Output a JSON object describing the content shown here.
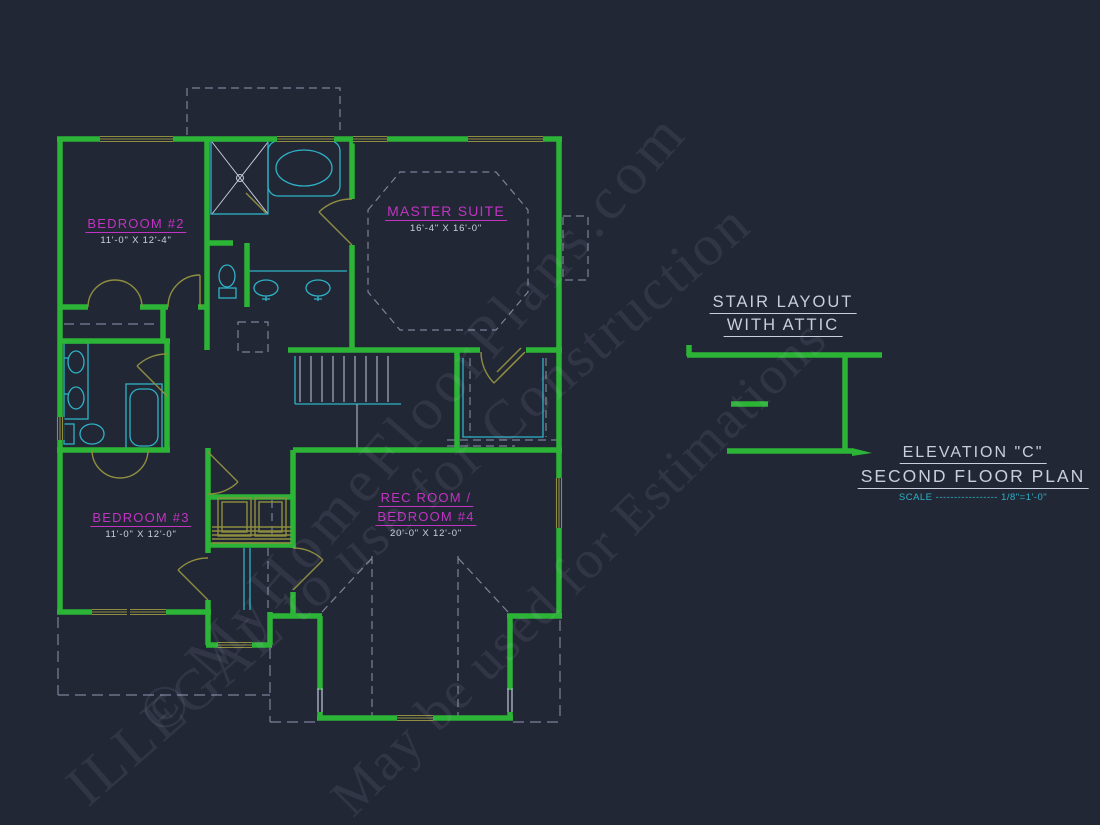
{
  "colors": {
    "background": "#222736",
    "wall_green": "#2cb437",
    "door_window_olive": "#8e8e3e",
    "fixture_cyan": "#2eb2c7",
    "room_label_magenta": "#c133c1",
    "text_light": "#ccd1e1",
    "dash_gray": "#8c94aa"
  },
  "plan": {
    "rooms": {
      "bedroom2": {
        "name": "BEDROOM #2",
        "dims": "11'-0\" X 12'-4\""
      },
      "master_suite": {
        "name": "MASTER SUITE",
        "dims": "16'-4\" X 16'-0\""
      },
      "bedroom3": {
        "name": "BEDROOM #3",
        "dims": "11'-0\" X 12'-0\""
      },
      "rec_room": {
        "name_line1": "REC ROOM /",
        "name_line2": "BEDROOM #4",
        "dims": "20'-0\" X 12'-0\""
      }
    }
  },
  "stair_layout": {
    "title_line1": "STAIR LAYOUT",
    "title_line2": "WITH ATTIC"
  },
  "title_block": {
    "elevation": "ELEVATION \"C\"",
    "plan_name": "SECOND FLOOR PLAN",
    "scale_label": "SCALE",
    "scale_dashes": "-----------------",
    "scale_value": "1/8\"=1'-0\""
  },
  "watermark": {
    "line1": "© MyHomeFloorPlans.com",
    "line2": "ILLEGAL to use for Construction",
    "line3": "May be used for Estimations"
  }
}
